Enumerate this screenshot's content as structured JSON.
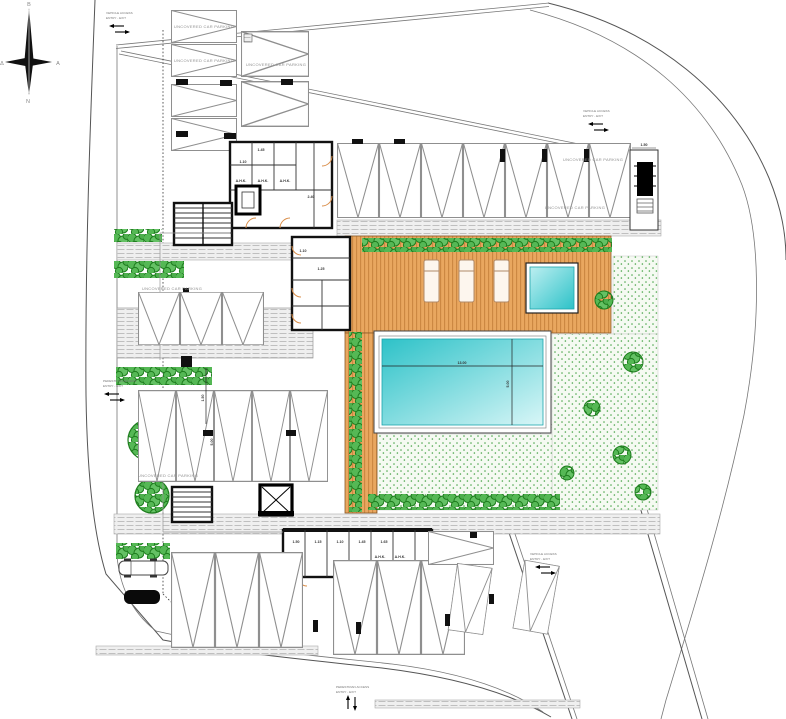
{
  "drawing": {
    "type_label": "site plan",
    "parking_label": "UNCOVERED CAR PARKING",
    "compass": {
      "north": "B",
      "south": "N",
      "east": "A",
      "west": "Δ"
    },
    "access": {
      "vehicle_line1": "VEHICLE ACCESS",
      "vehicle_line2": "ENTRY - EXIT",
      "pedestrian_line1": "PEDESTRIAN ACCESS",
      "pedestrian_line2": "ENTRY - EXIT"
    },
    "pool": {
      "length_label": "13.00",
      "width_label": "5.00"
    },
    "rooms": {
      "ahk": "A.H.K."
    },
    "dims": [
      "1.50",
      "1.10",
      "1.45",
      "2.40",
      "1.10",
      "1.25",
      "1.50",
      "1.15",
      "1.10",
      "1.45",
      "1.65",
      "1.50",
      "5.00"
    ],
    "colors": {
      "deck": "#e9a75f",
      "deck_stripe": "#c07b36",
      "pool_dark": "#2dc2c8",
      "pool_light": "#d8f6f7",
      "lawn_dot": "#49a549",
      "hedge_fill": "#55b855",
      "hedge_stroke": "#1e7d1e",
      "door": "#d98e4a",
      "wall": "#111111"
    }
  }
}
